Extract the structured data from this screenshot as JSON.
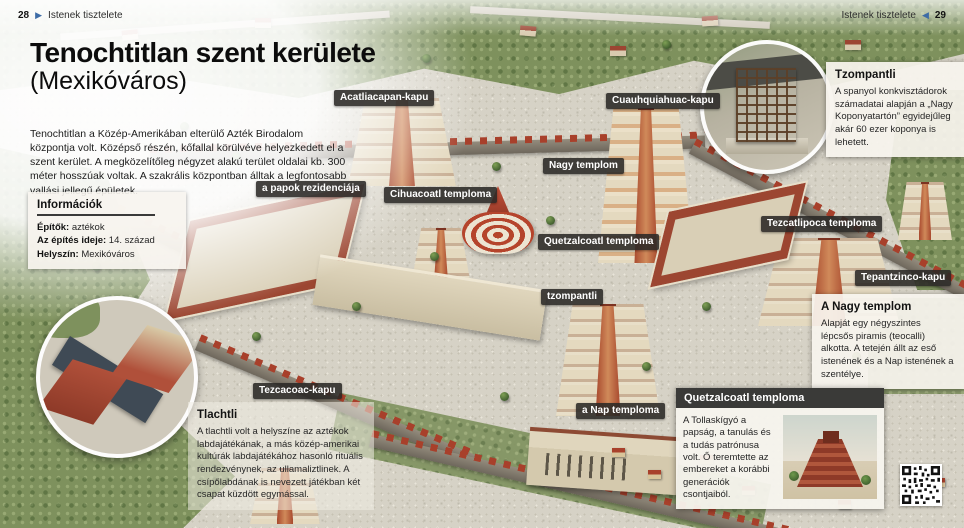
{
  "header_left": {
    "page": "28",
    "arrow": "▶",
    "section": "Istenek tisztelete"
  },
  "header_right": {
    "section": "Istenek tisztelete",
    "arrow": "◀",
    "page": "29"
  },
  "title": {
    "main": "Tenochtitlan szent kerülete",
    "sub": "(Mexikóváros)"
  },
  "intro": "Tenochtitlan a Közép-Amerikában elterülő Azték Birodalom központja volt. Középső részén, kőfallal körülvéve helyezkedett el a szent kerület. A megközelítőleg négyzet alakú terület oldalai kb. 300 méter hosszúak voltak. A szakrális központban álltak a legfontosabb vallási jellegű épületek.",
  "info_box": {
    "title": "Információk",
    "rows": [
      {
        "label": "Építők:",
        "value": " aztékok"
      },
      {
        "label": "Az építés ideje:",
        "value": " 14. század"
      },
      {
        "label": "Helyszín:",
        "value": " Mexikóváros"
      }
    ]
  },
  "map_labels": [
    {
      "text": "Acatliacapan-kapu"
    },
    {
      "text": "Cuauhquiahuac-kapu"
    },
    {
      "text": "Nagy templom"
    },
    {
      "text": "a papok rezidenciája"
    },
    {
      "text": "Cihuacoatl temploma"
    },
    {
      "text": "Quetzalcoatl temploma"
    },
    {
      "text": "Tezcatlipoca temploma"
    },
    {
      "text": "Tepantzinco-kapu"
    },
    {
      "text": "tzompantli"
    },
    {
      "text": "Tezcacoac-kapu"
    },
    {
      "text": "a Nap temploma"
    }
  ],
  "callouts": {
    "tzompantli": {
      "title": "Tzompantli",
      "body": "A spanyol konkvisztádorok számadatai alapján a „Nagy Koponyatartón” egyidejűleg akár 60 ezer koponya is lehetett."
    },
    "nagy_templom": {
      "title": "A Nagy templom",
      "body": "Alapját egy négyszintes lépcsős piramis (teocalli) alkotta. A tetején állt az eső istenének és a Nap istenének a szentélye."
    },
    "quetzalcoatl": {
      "title": "Quetzalcoatl temploma",
      "body": "A Tollaskígyó a papság, a tanulás és a tudás patrónusa volt. Ő teremtette az embereket a korábbi generációk csontjaiból."
    },
    "tlachtli": {
      "title": "Tlachtli",
      "body": "A tlachtli volt a helyszíne az aztékok labdajátékának, a más közép-amerikai kultúrák labdajátékához hasonló rituális rendezvénynek, az ullamaliztlinek. A csípőlabdának is nevezett játékban két csapat küzdött egymással."
    }
  },
  "colors": {
    "label_chip": "#2a2825",
    "accent_blue": "#3e6ca6",
    "wall_red": "#a8402b",
    "plaza": "#d6d2c6",
    "vegetation": "#7e915d"
  }
}
